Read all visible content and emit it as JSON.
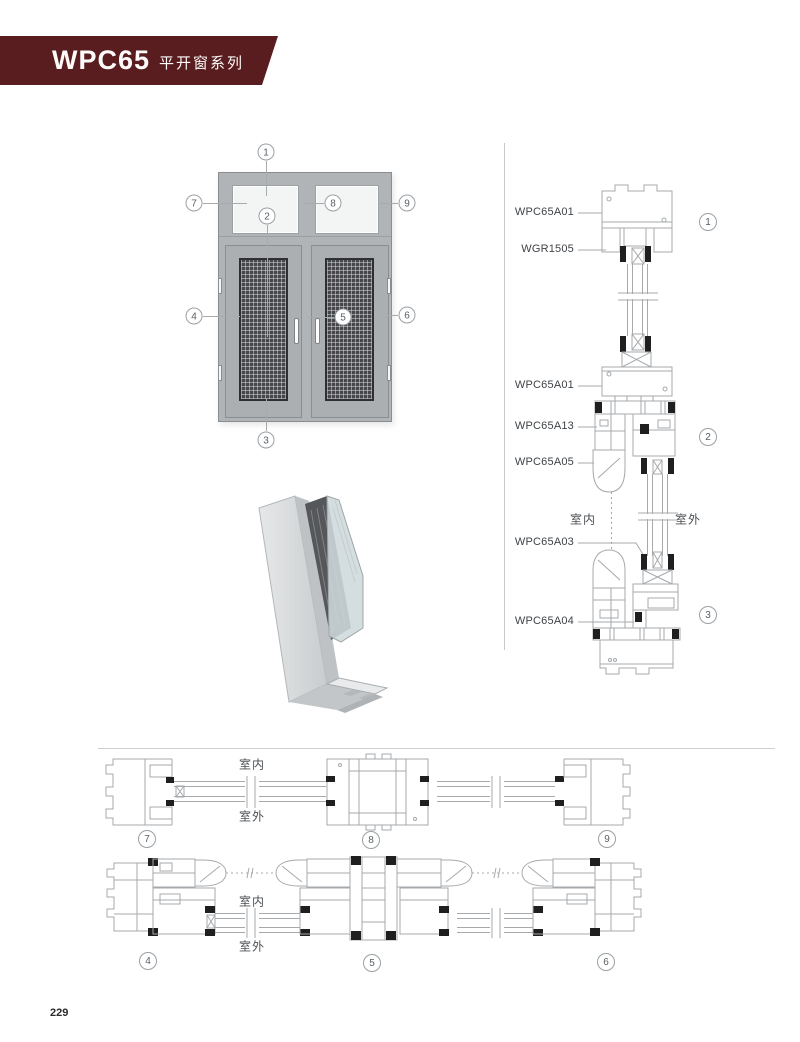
{
  "page_number": "229",
  "header": {
    "series_code": "WPC65",
    "series_name": "平开窗系列"
  },
  "colors": {
    "banner": "#591c1f",
    "drawing_line": "#a6aaad",
    "frame_gray": "#b0b4b7",
    "mesh_dark": "#46474b",
    "glass_light": "#f3f5f5"
  },
  "elevation": {
    "callouts": [
      "1",
      "2",
      "3",
      "4",
      "5",
      "6",
      "7",
      "8",
      "9"
    ]
  },
  "right_column": {
    "labels": [
      "WPC65A01",
      "WGR1505",
      "WPC65A01",
      "WPC65A13",
      "WPC65A05",
      "WPC65A03",
      "WPC65A04"
    ],
    "indoor": "室内",
    "outdoor": "室外",
    "sections": [
      "1",
      "2",
      "3"
    ]
  },
  "bottom_panel": {
    "row1": {
      "indoor": "室内",
      "outdoor": "室外",
      "sections": [
        "7",
        "8",
        "9"
      ]
    },
    "row2": {
      "indoor": "室内",
      "outdoor": "室外",
      "sections": [
        "4",
        "5",
        "6"
      ]
    }
  }
}
